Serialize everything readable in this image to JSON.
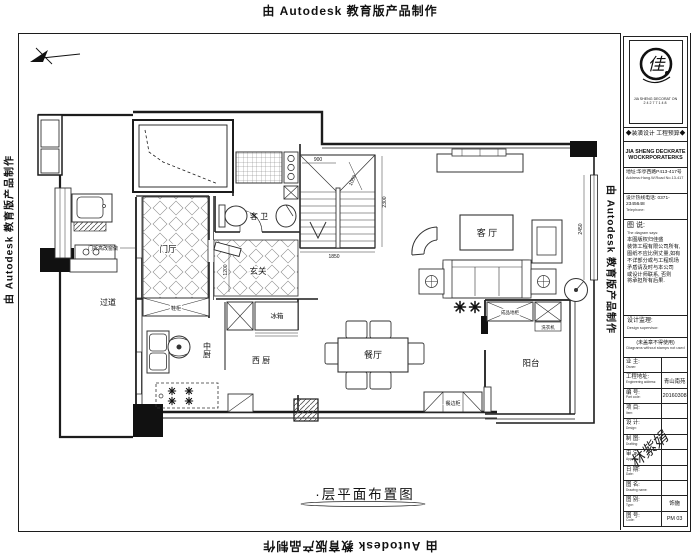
{
  "page": {
    "watermark": "由 Autodesk 教育版产品制作",
    "drawing_title": "·层平面布置图"
  },
  "plan": {
    "rooms": {
      "foyer": "门厅",
      "entry": "玄关",
      "guest_bath": "客 卫",
      "corridor": "过道",
      "kitchen_cn": "中厨",
      "kitchen_west": "西 厨",
      "dining": "餐厅",
      "living": "客 厅",
      "balcony": "阳台"
    },
    "furniture": {
      "fridge": "冰箱",
      "shoe_cabinet": "鞋柜",
      "sideboard": "餐边柜",
      "balcony_cabinet": "成品地柜",
      "washer": "洗衣机"
    },
    "dims": {
      "stair_width": "900",
      "stair_run": "1050",
      "stair_depth": "2300",
      "stair_total": "1850",
      "entry_depth": "1200",
      "living_window": "2450"
    },
    "notes": {
      "window_note": "门拆高改窗做"
    }
  },
  "titleblock": {
    "logo_char": "佳",
    "logo_caption": "JIA SHENG DECORAT ON",
    "logo_sub": "24277148",
    "tagline": "◆装潢设计 工程预算◆",
    "company_en_1": "JIA SHENG DECKRATE",
    "company_en_2": "WOCKRPORATERKS",
    "address_cn": "地址:华亭西路P413-417号",
    "address_en": "Address:Hang.W.Road No.13-417",
    "tel_cn": "设计热线电话: 0371-2345648",
    "tel_en": "Telephone:",
    "diagram_cn": "图 说:",
    "diagram_en": "The diagram says:",
    "disclaimer": [
      "本图版权归佳盛",
      "装饰工程有限公司所有,",
      "图纸不应比例丈量,如有",
      "不详部分或与工程现场",
      "矛盾请及时与本公司",
      "或设计师联系, 否则",
      "将承担所有后果."
    ],
    "supervisor_cn": "设计监理:",
    "supervisor_en": "Design supervisor:",
    "stamp_cn": "(未盖章不得使用)",
    "stamp_en": "Diagrams without stamps not used",
    "watermark_sign": "林紫娟",
    "rows": [
      {
        "label": "业 主:",
        "en": "Owner:",
        "value": ""
      },
      {
        "label": "工程地址:",
        "en": "Engineering address:",
        "value": "青山南苑"
      },
      {
        "label": "编 号:",
        "en": "Part code:",
        "value": "20160308"
      },
      {
        "label": "项 目:",
        "en": "Item:",
        "value": ""
      },
      {
        "label": "设 计:",
        "en": "Design:",
        "value": ""
      },
      {
        "label": "制 图:",
        "en": "Drafting:",
        "value": ""
      },
      {
        "label": "审 定:",
        "en": "Approval:",
        "value": ""
      },
      {
        "label": "日 期:",
        "en": "Date:",
        "value": ""
      },
      {
        "label": "图 名:",
        "en": "Drawing name:",
        "value": ""
      },
      {
        "label": "图 别:",
        "en": "Type:",
        "value": "饰施"
      },
      {
        "label": "图 号:",
        "en": "Code:",
        "value": "PM 03"
      }
    ]
  }
}
